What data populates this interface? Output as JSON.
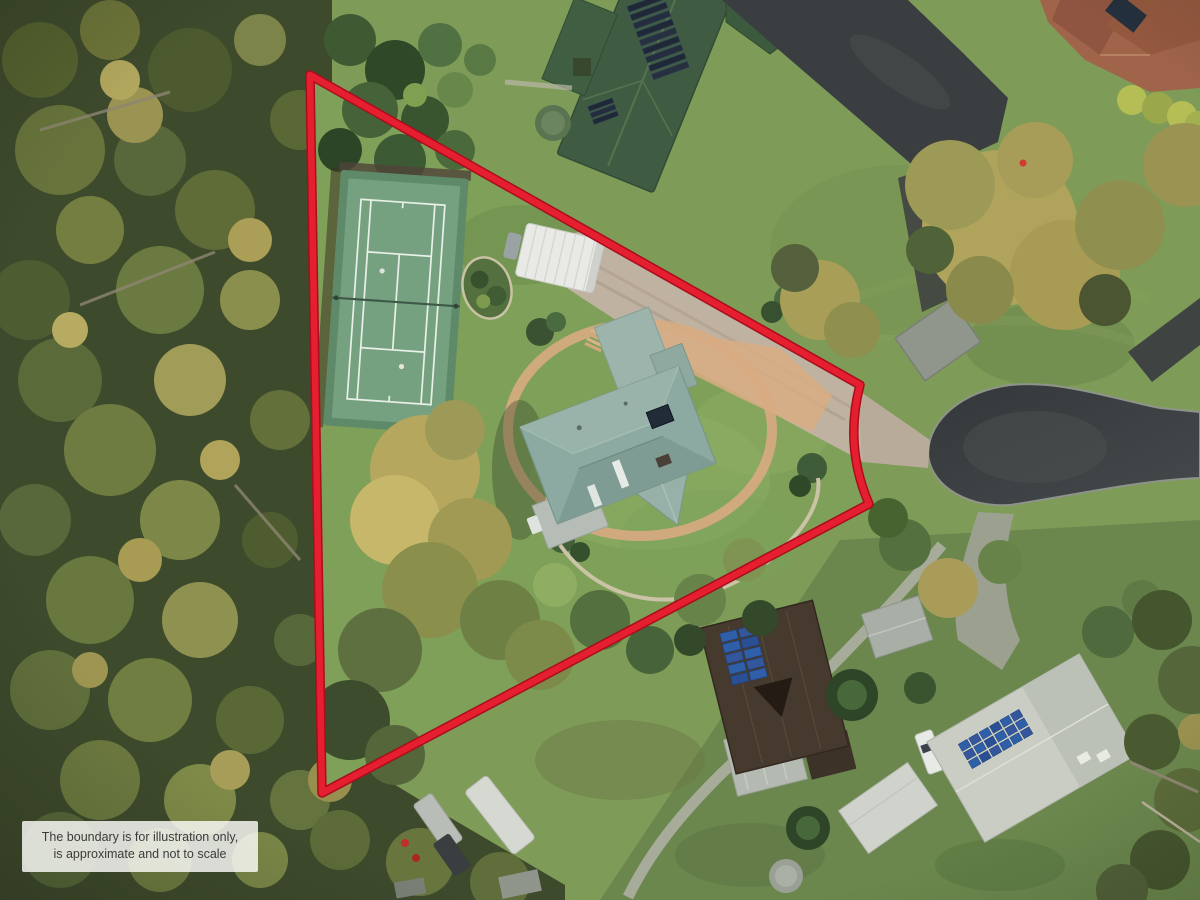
{
  "disclaimer": {
    "line1": "The boundary is for illustration only,",
    "line2": "is approximate and not to scale"
  },
  "colors": {
    "boundary": "#e51e30",
    "boundary_shadow": "#a80e1c",
    "lawn": "#7e9c58",
    "lawn_bright": "#8fb065",
    "forest": "#3e4a2c",
    "court_apron": "#5f8a6a",
    "court_surface": "#76a180",
    "court_line": "#e9f0e7",
    "house_roof": "#8caaa1",
    "carport_white": "#e9eae5",
    "gravel": "#c0b2a1",
    "paving": "#d8ab82",
    "neighbor_roof": "#3f5c42",
    "terracotta_roof": "#a0644a",
    "asphalt": "#3a3e40",
    "concrete": "#9ba08f",
    "solar_blue": "#2e5fa8",
    "solar_dark": "#1f2836",
    "roof_white": "#c9cdc4",
    "roof_dark_brown": "#463a2e",
    "tank_green": "#5a7350",
    "tank_grey": "#9aa096"
  }
}
